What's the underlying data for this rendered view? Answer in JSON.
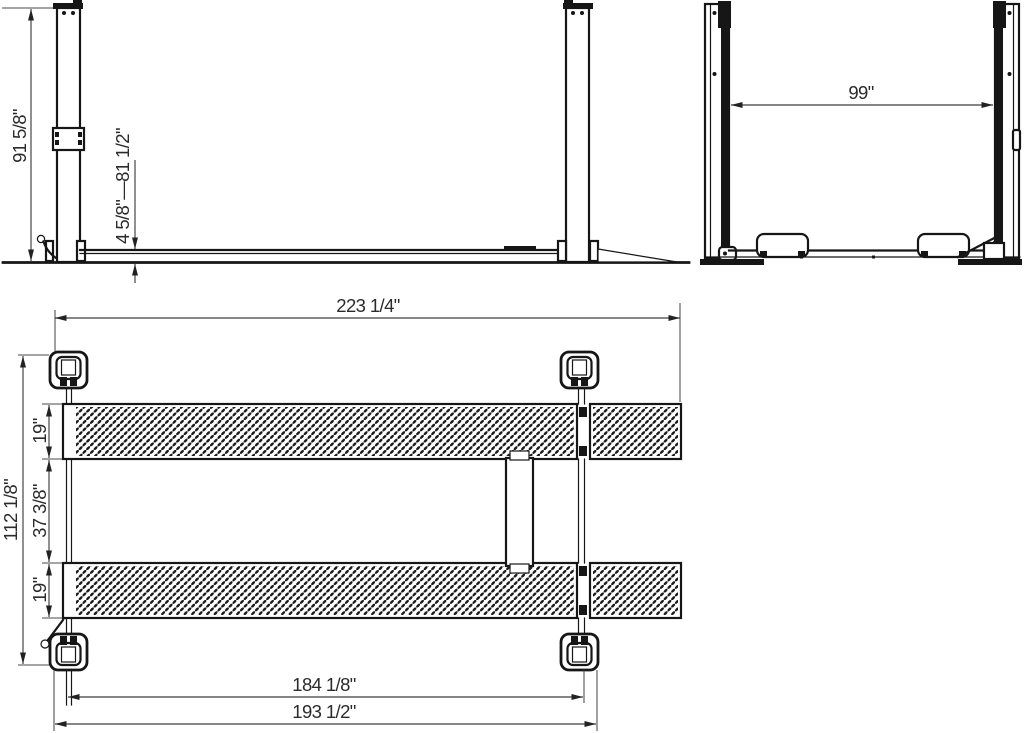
{
  "diagram": {
    "name": "Four-post vehicle lift dimension drawing",
    "views": [
      {
        "id": "side",
        "name": "side elevation view"
      },
      {
        "id": "front",
        "name": "front elevation view"
      },
      {
        "id": "plan",
        "name": "top plan view"
      }
    ],
    "line_color": "#161616",
    "background_color": "#ffffff",
    "dimensions": {
      "column_height": "91 5/8\"",
      "lifting_height_range": "4 5/8\"—81 1/2\"",
      "width_between_columns": "99\"",
      "overall_length": "223 1/4\"",
      "overall_width": "112 1/8\"",
      "runway_width_top": "19\"",
      "space_between_runways": "37 3/8\"",
      "runway_width_bottom": "19\"",
      "length_between_locks": "184 1/8\"",
      "rail_to_rail_length": "193 1/2\""
    }
  }
}
